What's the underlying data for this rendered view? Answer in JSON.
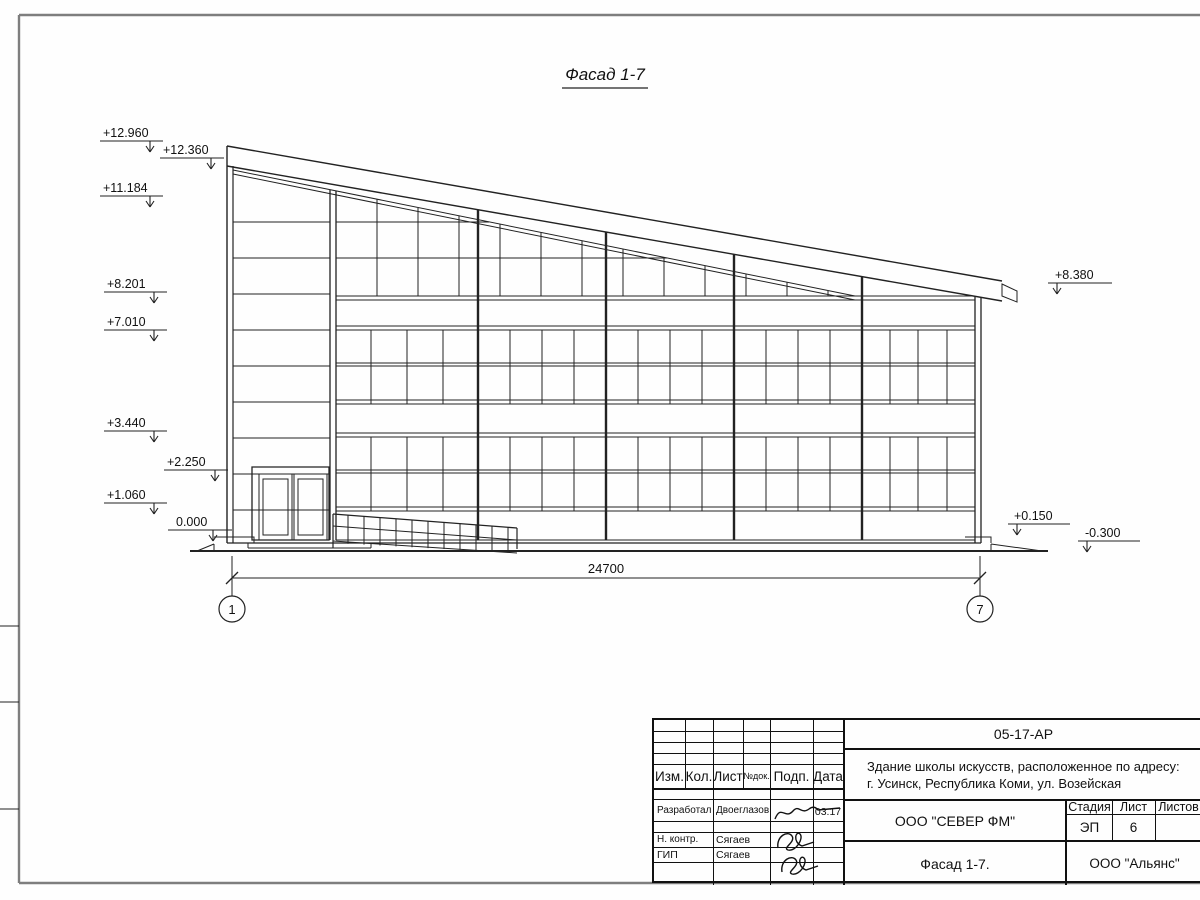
{
  "facade": {
    "title": "Фасад 1-7",
    "elevations_left": [
      "+12.960",
      "+12.360",
      "+11.184",
      "+8.201",
      "+7.010",
      "+3.440",
      "+2.250",
      "+1.060",
      "0.000"
    ],
    "elevations_right": [
      "+8.380",
      "+0.150",
      "-0.300"
    ],
    "overall_dimension": "24700",
    "axis_start": "1",
    "axis_end": "7"
  },
  "title_block": {
    "doc_code": "05-17-АР",
    "project_address_line1": "Здание школы искусств, расположенное по адресу:",
    "project_address_line2": "г. Усинск, Республика Коми, ул. Возейская",
    "col_izm": "Изм.",
    "col_kol": "Кол.",
    "col_list": "Лист",
    "col_ndok": "№док.",
    "col_podp": "Подп.",
    "col_data": "Дата",
    "developed_by_label": "Разработал",
    "developed_by_name": "Двоеглазов",
    "developed_date": "03.17",
    "ncontrol_label": "Н. контр.",
    "ncontrol_name": "Сягаев",
    "gip_label": "ГИП",
    "gip_name": "Сягаев",
    "design_company": "ООО \"СЕВЕР ФМ\"",
    "sheet_name": "Фасад 1-7.",
    "client_company": "ООО \"Альянс\"",
    "stage_label": "Стадия",
    "list_label": "Лист",
    "listov_label": "Листов",
    "stage_value": "ЭП",
    "list_value": "6"
  }
}
